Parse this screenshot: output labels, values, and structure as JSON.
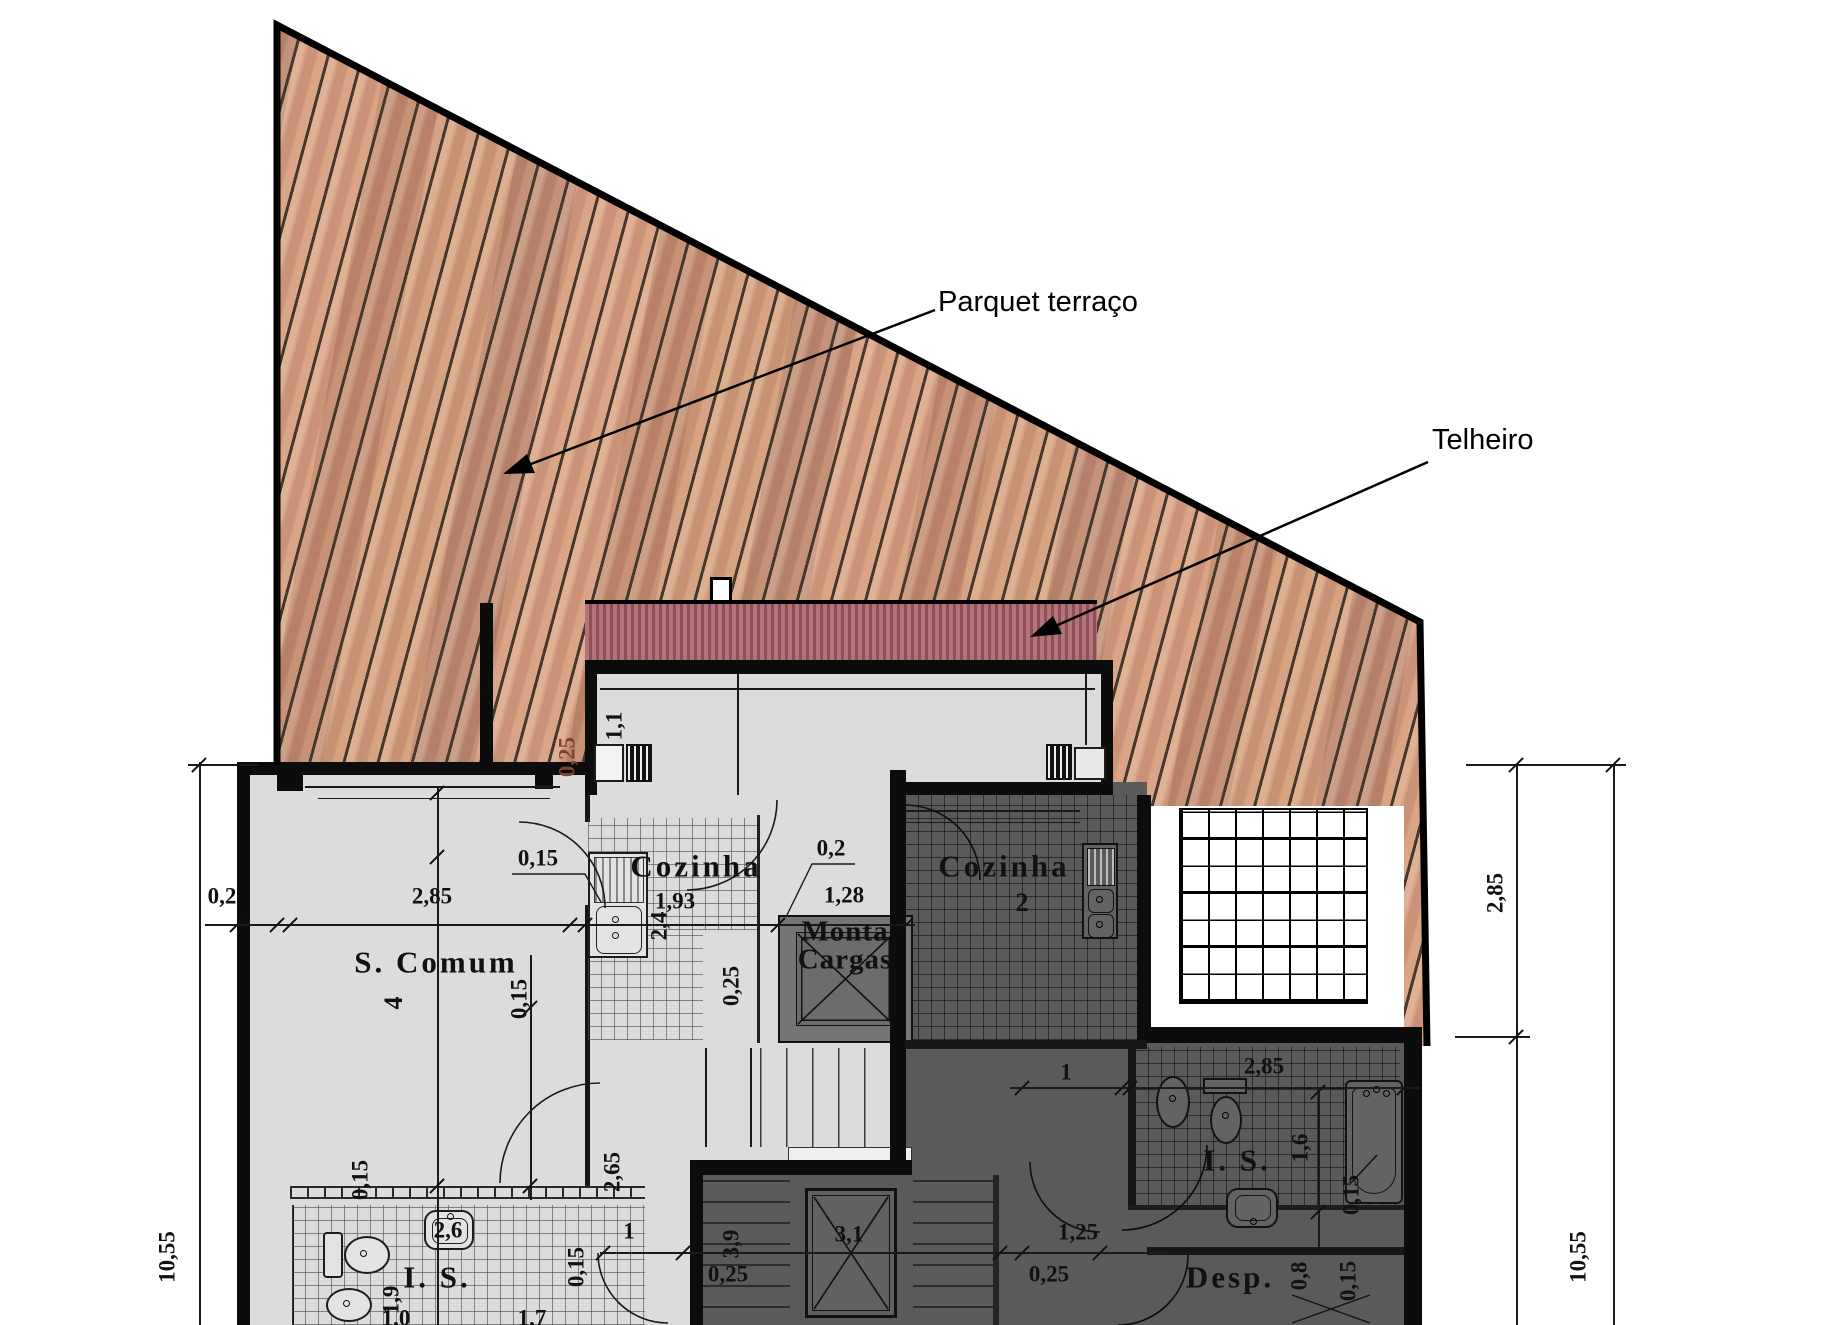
{
  "title": "Floor plan with roof deck (terrace level)",
  "colors": {
    "wall": "#0c0c0c",
    "deck_wood": "#cf9a7b",
    "deck_seam": "#3e3228",
    "roof_red": "#a5626b",
    "floor_light": "#dcdcda",
    "floor_dark": "#5a5a5a",
    "red_dim_label": "#7d452f"
  },
  "annotations": {
    "parquet": "Parquet terraço",
    "telheiro": "Telheiro"
  },
  "rooms": {
    "s_comum": {
      "label": "S. Comum",
      "num": "4"
    },
    "cozinha1": {
      "label": "Cozinha",
      "dim": "1,93"
    },
    "cozinha2": {
      "label": "Cozinha",
      "num": "2"
    },
    "monta": {
      "line1": "Monta",
      "line2": "Cargas"
    },
    "is1": {
      "label": "I. S."
    },
    "is2": {
      "label": "I. S."
    },
    "desp": {
      "label": "Desp."
    }
  },
  "dims": [
    {
      "v": "0,2"
    },
    {
      "v": "10,55"
    },
    {
      "v": "2,85"
    },
    {
      "v": "0,15"
    },
    {
      "v": "0,25"
    },
    {
      "v": "1,1"
    },
    {
      "v": "0,2"
    },
    {
      "v": "1,28"
    },
    {
      "v": "0,25"
    },
    {
      "v": "2,4"
    },
    {
      "v": "0,15"
    },
    {
      "v": "0,15"
    },
    {
      "v": "2,6"
    },
    {
      "v": "1,9"
    },
    {
      "v": "0,15"
    },
    {
      "v": "2,65"
    },
    {
      "v": "1"
    },
    {
      "v": "3,9"
    },
    {
      "v": "0,25"
    },
    {
      "v": "3,1"
    },
    {
      "v": "0,25"
    },
    {
      "v": "1,25"
    },
    {
      "v": "1"
    },
    {
      "v": "2,85"
    },
    {
      "v": "1,6"
    },
    {
      "v": "0,15"
    },
    {
      "v": "0,8"
    },
    {
      "v": "0,15"
    },
    {
      "v": "10,55"
    },
    {
      "v": "2,85"
    },
    {
      "v": "1,0"
    },
    {
      "v": "1,7"
    },
    {
      "v": "1,93"
    }
  ]
}
